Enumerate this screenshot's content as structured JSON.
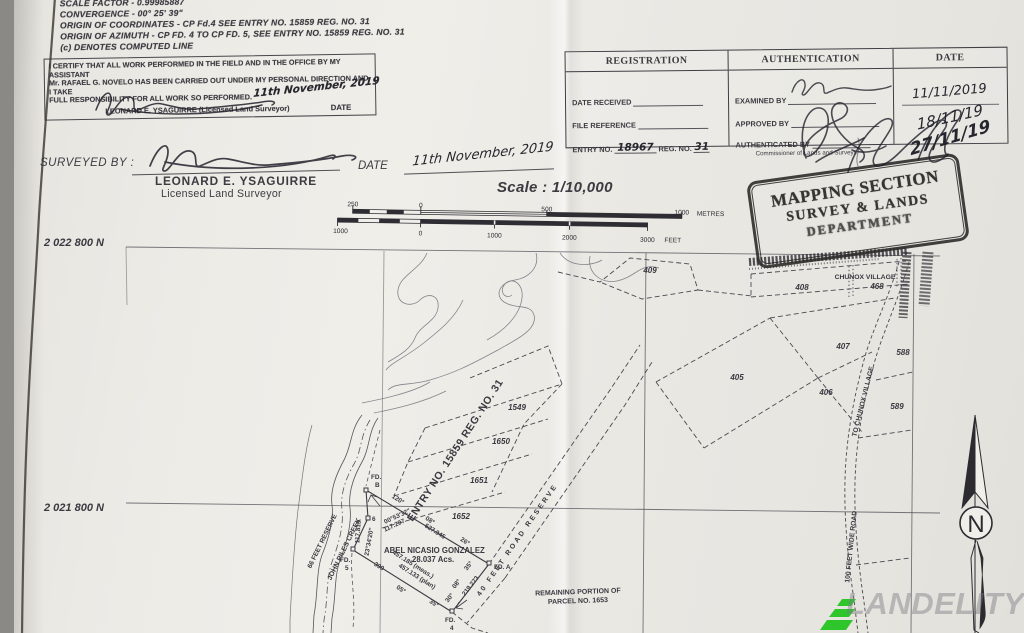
{
  "page": {
    "notes": [
      "SCALE FACTOR - 0.99985887",
      "CONVERGENCE - 00° 25' 39\"",
      "ORIGIN OF COORDINATES - CP Fd.4 SEE ENTRY NO. 15859 REG. NO. 31",
      "ORIGIN OF AZIMUTH - CP FD. 4 TO CP FD. 5, SEE ENTRY NO. 15859 REG. NO. 31",
      "(c)   DENOTES COMPUTED LINE"
    ]
  },
  "certification": {
    "line1": "I CERTIFY THAT ALL WORK PERFORMED IN THE FIELD AND IN THE OFFICE BY MY ASSISTANT",
    "line2": "Mr. RAFAEL G. NOVELO HAS BEEN CARRIED OUT UNDER MY PERSONAL DIRECTION AND I TAKE",
    "line3": "FULL RESPONSIBILITY FOR ALL WORK SO PERFORMED.",
    "handwritten_date": "11th November, 2019",
    "signatory": "LEONARD E. YSAGUIRRE (Licensed Land Surveyor)",
    "date_label": "DATE"
  },
  "registration": {
    "col_registration": "REGISTRATION",
    "col_authentication": "AUTHENTICATION",
    "col_date": "DATE",
    "date_received_label": "DATE RECEIVED",
    "file_reference_label": "FILE REFERENCE",
    "entry_no_label": "ENTRY NO.",
    "entry_no_value": "18967",
    "reg_no_label": "REG. NO.",
    "reg_no_value": "31",
    "examined_by_label": "EXAMINED BY",
    "approved_by_label": "APPROVED BY",
    "authenticated_by_label": "AUTHENTICATED BY",
    "authenticated_by_note": "Commissioner of Lands and Surveys",
    "date_value_1": "11/11/2019",
    "date_value_2": "18/11/19",
    "date_value_3": "27/11/19"
  },
  "surveyed": {
    "label": "SURVEYED BY :",
    "name": "LEONARD E. YSAGUIRRE",
    "title": "Licensed Land Surveyor",
    "date_label": "DATE",
    "date_value": "11th November, 2019"
  },
  "scalebar": {
    "title": "Scale : 1/10,000",
    "m_ticks": [
      "250",
      "0",
      "500",
      "1000"
    ],
    "m_unit": "METRES",
    "ft_ticks": [
      "1000",
      "0",
      "1000",
      "2000",
      "3000"
    ],
    "ft_unit": "FEET"
  },
  "stamp": {
    "line1": "MAPPING SECTION",
    "line2": "SURVEY & LANDS",
    "line3": "DEPARTMENT"
  },
  "map": {
    "northing_top": "2 022 800 N",
    "northing_bottom": "2 021 800 N",
    "village": "CHUNOX VILLAGE",
    "p409": "409",
    "p408": "408",
    "p468": "468",
    "p407": "407",
    "p588": "588",
    "p405": "405",
    "p406": "406",
    "p589": "589",
    "p1549": "1549",
    "p1650": "1650",
    "p1651": "1651",
    "p1652": "1652",
    "entry_diagonal": "ENTRY NO. 15859 REG. NO. 31",
    "road_to_village": "TO CHUNOX VILLAGE",
    "road_100ft": "100 FEET WIDE ROAD",
    "road_reserve": "40  FEET  ROAD  RESERVE",
    "creek": "JOHN PILES CREEK",
    "reserve66": "66 FEET RESERVE",
    "owner_name": "ABEL NICASIO GONZALEZ",
    "owner_area": "28.037 Acs.",
    "remaining1": "REMAINING PORTION OF",
    "remaining2": "PARCEL NO. 1653",
    "m_117815": "117.815",
    "m_2334": "23°34'20\"",
    "m_0053": "00°53'32\"",
    "m_117297": "117.297",
    "m_527945": "527.945",
    "m_457meas": "457.185 (meas.)",
    "m_457plan": "457.133 (plan)",
    "m_219273": "219.273",
    "m_390": "390",
    "b_120": "120°",
    "b_08a": "08°",
    "b_26": "26°",
    "b_35a": "35°",
    "b_08b": "08°",
    "b_30": "30°",
    "b_35b": "35°",
    "b_05": "05°",
    "fd_b_l1": "FD.",
    "fd_b_l2": "B",
    "fd_6": "6",
    "fd_5_l1": "FD.",
    "fd_5_l2": "5",
    "fd_a": "FD. A",
    "fd_4_l1": "FD.",
    "fd_4_l2": "4",
    "north": "N"
  },
  "watermark": {
    "text": "LANDELITY"
  }
}
